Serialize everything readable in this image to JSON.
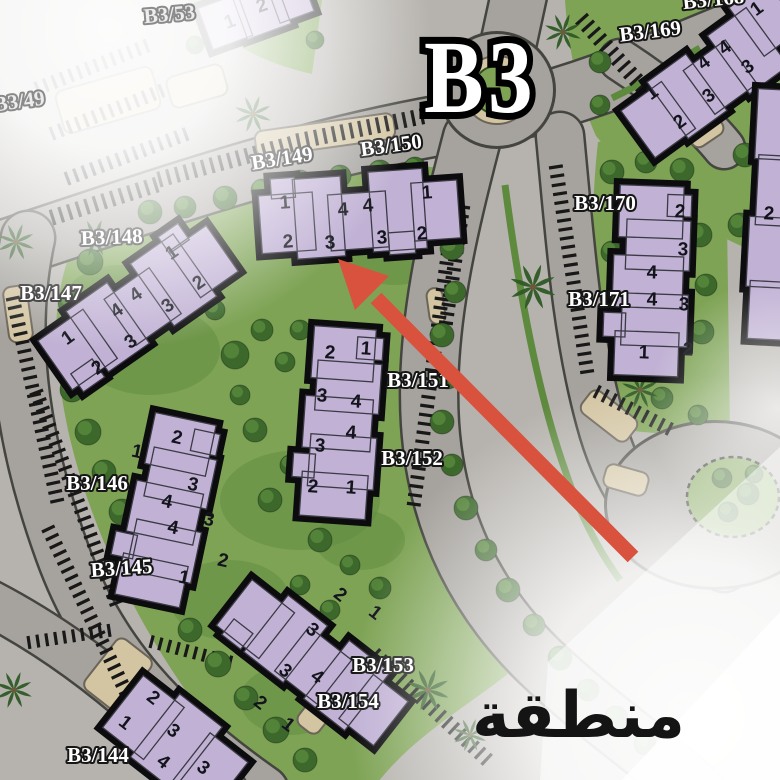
{
  "title": "B3",
  "arabic_label": "منطقة",
  "colors": {
    "base": "#b6b3ae",
    "road": "#a6a39e",
    "road_casing": "#45453f",
    "grass": "#7ea355",
    "grass_dark": "#5e8a3e",
    "tree": "#3c682c",
    "tree_hi": "#5d8f3d",
    "palm": "#2e5a25",
    "tan": "#d3c5a2",
    "tan_stroke": "#6b6459",
    "building_fill": "#c1b2d5",
    "building_stroke": "#0c0c0e",
    "unit_color": "#14141c",
    "label_fill": "#ffffff",
    "label_stroke": "#161616",
    "faded_label_fill": "#ececec",
    "faded_label_stroke": "#787878",
    "arrow": "#d8523e",
    "tick": "#181818"
  },
  "street_labels": [
    {
      "text": "B3/53",
      "x": 170,
      "y": 21,
      "rot": -5,
      "faded": true
    },
    {
      "text": "B3/49",
      "x": 20,
      "y": 108,
      "rot": -8,
      "faded": true
    },
    {
      "text": "B3/149",
      "x": 283,
      "y": 165,
      "rot": -9,
      "faded": false
    },
    {
      "text": "B3/150",
      "x": 392,
      "y": 152,
      "rot": -8,
      "faded": false
    },
    {
      "text": "B3/148",
      "x": 112,
      "y": 244,
      "rot": -2,
      "faded": false
    },
    {
      "text": "B3/147",
      "x": 51,
      "y": 300,
      "rot": 0,
      "faded": false
    },
    {
      "text": "B3/146",
      "x": 97,
      "y": 490,
      "rot": 0,
      "faded": false
    },
    {
      "text": "B3/145",
      "x": 122,
      "y": 575,
      "rot": -4,
      "faded": false
    },
    {
      "text": "B3/144",
      "x": 98,
      "y": 762,
      "rot": 0,
      "faded": false
    },
    {
      "text": "B3/151",
      "x": 418,
      "y": 387,
      "rot": 0,
      "faded": false
    },
    {
      "text": "B3/152",
      "x": 412,
      "y": 465,
      "rot": 0,
      "faded": false
    },
    {
      "text": "B3/153",
      "x": 383,
      "y": 672,
      "rot": 0,
      "faded": false
    },
    {
      "text": "B3/154",
      "x": 348,
      "y": 708,
      "rot": 0,
      "faded": false
    },
    {
      "text": "B3/168",
      "x": 714,
      "y": 6,
      "rot": -6,
      "faded": false
    },
    {
      "text": "B3/169",
      "x": 651,
      "y": 38,
      "rot": -7,
      "faded": false
    },
    {
      "text": "B3/170",
      "x": 605,
      "y": 210,
      "rot": 0,
      "faded": false
    },
    {
      "text": "B3/171",
      "x": 599,
      "y": 306,
      "rot": 0,
      "faded": false
    }
  ],
  "buildings": [
    {
      "id": "b3-149-150",
      "cx": 357,
      "cy": 217,
      "rot": -4,
      "blocks": [
        [
          -97,
          -28,
          54,
          58
        ],
        [
          -62,
          -42,
          48,
          80
        ],
        [
          -28,
          -24,
          58,
          56
        ],
        [
          14,
          -44,
          54,
          80
        ],
        [
          56,
          -30,
          46,
          58
        ],
        [
          -84,
          -44,
          24,
          20
        ],
        [
          30,
          18,
          26,
          22
        ]
      ],
      "units": [
        [
          "1",
          285,
          203
        ],
        [
          "4",
          343,
          210
        ],
        [
          "4",
          368,
          206
        ],
        [
          "1",
          427,
          193
        ],
        [
          "2",
          288,
          242
        ],
        [
          "3",
          330,
          243
        ],
        [
          "3",
          382,
          238
        ],
        [
          "2",
          422,
          234
        ]
      ]
    },
    {
      "id": "b3-147-148",
      "cx": 137,
      "cy": 308,
      "rot": -35,
      "blocks": [
        [
          -100,
          -30,
          55,
          60
        ],
        [
          -60,
          -38,
          50,
          74
        ],
        [
          -22,
          -26,
          55,
          56
        ],
        [
          20,
          -40,
          52,
          76
        ],
        [
          58,
          -28,
          46,
          56
        ],
        [
          -92,
          16,
          26,
          22
        ],
        [
          58,
          -46,
          24,
          20
        ]
      ],
      "units": [
        [
          "1",
          172,
          253
        ],
        [
          "2",
          199,
          283
        ],
        [
          "4",
          136,
          295
        ],
        [
          "4",
          117,
          311
        ],
        [
          "3",
          168,
          306
        ],
        [
          "1",
          68,
          338
        ],
        [
          "3",
          131,
          342
        ],
        [
          "2",
          98,
          368
        ]
      ]
    },
    {
      "id": "b3-151-152",
      "cx": 344,
      "cy": 420,
      "rot": 4,
      "blocks": [
        [
          -36,
          -92,
          62,
          52
        ],
        [
          -30,
          -58,
          64,
          50
        ],
        [
          -40,
          -22,
          68,
          52
        ],
        [
          -32,
          16,
          66,
          52
        ],
        [
          -38,
          54,
          66,
          44
        ],
        [
          8,
          -84,
          26,
          22
        ],
        [
          -48,
          36,
          22,
          24
        ]
      ],
      "units": [
        [
          "2",
          330,
          353
        ],
        [
          "1",
          366,
          349
        ],
        [
          "3",
          322,
          396
        ],
        [
          "4",
          356,
          402
        ],
        [
          "4",
          351,
          433
        ],
        [
          "3",
          320,
          446
        ],
        [
          "2",
          313,
          487
        ],
        [
          "1",
          351,
          488
        ]
      ]
    },
    {
      "id": "b3-145-146",
      "cx": 172,
      "cy": 508,
      "rot": 12,
      "blocks": [
        [
          -36,
          -90,
          62,
          52
        ],
        [
          -30,
          -56,
          64,
          50
        ],
        [
          -40,
          -20,
          68,
          52
        ],
        [
          -32,
          18,
          66,
          52
        ],
        [
          -38,
          54,
          66,
          42
        ],
        [
          6,
          -82,
          26,
          22
        ],
        [
          -50,
          34,
          22,
          24
        ]
      ],
      "units": [
        [
          "1",
          137,
          452
        ],
        [
          "2",
          177,
          438
        ],
        [
          "3",
          193,
          485
        ],
        [
          "4",
          167,
          502
        ],
        [
          "4",
          173,
          528
        ],
        [
          "3",
          209,
          520
        ],
        [
          "2",
          223,
          561
        ],
        [
          "1",
          184,
          578
        ]
      ]
    },
    {
      "id": "b3-153-154",
      "cx": 312,
      "cy": 662,
      "rot": 38,
      "blocks": [
        [
          -98,
          -28,
          54,
          58
        ],
        [
          -60,
          -38,
          50,
          72
        ],
        [
          -24,
          -26,
          54,
          56
        ],
        [
          16,
          -40,
          52,
          74
        ],
        [
          56,
          -28,
          44,
          56
        ],
        [
          -88,
          14,
          24,
          20
        ]
      ],
      "units": [
        [
          "2",
          340,
          595
        ],
        [
          "1",
          375,
          613
        ],
        [
          "3",
          312,
          630
        ],
        [
          "3",
          285,
          671
        ],
        [
          "4",
          317,
          677
        ],
        [
          "2",
          260,
          703
        ],
        [
          "1",
          288,
          725
        ]
      ]
    },
    {
      "id": "b3-144",
      "cx": 168,
      "cy": 738,
      "rot": 38,
      "blocks": [
        [
          -58,
          -34,
          52,
          66
        ],
        [
          -18,
          -42,
          54,
          80
        ],
        [
          30,
          -30,
          48,
          62
        ]
      ],
      "units": [
        [
          "2",
          153,
          698
        ],
        [
          "1",
          125,
          723
        ],
        [
          "3",
          173,
          731
        ],
        [
          "4",
          163,
          762
        ],
        [
          "3",
          203,
          768
        ]
      ]
    },
    {
      "id": "b3-170-171",
      "cx": 655,
      "cy": 278,
      "rot": 2,
      "blocks": [
        [
          -38,
          -92,
          64,
          52
        ],
        [
          -30,
          -58,
          64,
          50
        ],
        [
          -42,
          -22,
          70,
          52
        ],
        [
          -32,
          16,
          66,
          52
        ],
        [
          -38,
          54,
          64,
          44
        ],
        [
          10,
          -84,
          24,
          22
        ],
        [
          -50,
          36,
          22,
          24
        ]
      ],
      "units": [
        [
          "2",
          680,
          212
        ],
        [
          "3",
          683,
          250
        ],
        [
          "4",
          652,
          273
        ],
        [
          "4",
          652,
          300
        ],
        [
          "3",
          684,
          305
        ],
        [
          "2",
          688,
          350
        ],
        [
          "1",
          644,
          353
        ]
      ]
    },
    {
      "id": "b3-168-169",
      "cx": 707,
      "cy": 83,
      "rot": -36,
      "blocks": [
        [
          -86,
          -28,
          50,
          58
        ],
        [
          -48,
          -36,
          48,
          70
        ],
        [
          -12,
          -24,
          52,
          54
        ],
        [
          28,
          -38,
          48,
          72
        ],
        [
          62,
          -48,
          46,
          60
        ]
      ],
      "units": [
        [
          "1",
          652,
          93
        ],
        [
          "2",
          680,
          122
        ],
        [
          "4",
          704,
          63
        ],
        [
          "4",
          725,
          48
        ],
        [
          "3",
          709,
          96
        ],
        [
          "3",
          748,
          67
        ],
        [
          "1",
          757,
          9
        ]
      ]
    },
    {
      "id": "b3-53-fragment",
      "cx": 247,
      "cy": 14,
      "rot": -20,
      "blocks": [
        [
          -44,
          -22,
          42,
          44
        ],
        [
          -8,
          -30,
          46,
          54
        ],
        [
          28,
          -18,
          36,
          38
        ]
      ],
      "units": [
        [
          "1",
          230,
          22
        ],
        [
          "2",
          262,
          6
        ]
      ]
    },
    {
      "id": "right-edge-fragment",
      "cx": 782,
      "cy": 210,
      "rot": 3,
      "blocks": [
        [
          -30,
          -120,
          56,
          70
        ],
        [
          -26,
          -54,
          52,
          70
        ],
        [
          -32,
          8,
          56,
          70
        ],
        [
          -28,
          72,
          50,
          58
        ]
      ],
      "units": [
        [
          "2",
          769,
          214
        ]
      ]
    }
  ],
  "roads": [
    {
      "d": "M -20,258 C 140,206 290,150 460,122 C 570,102 660,62 790,8",
      "w": 58
    },
    {
      "d": "M 28,238 C 8,330 20,436 62,552 C 98,652 162,722 262,792",
      "w": 52
    },
    {
      "d": "M 472,138 C 448,230 424,330 430,424 C 436,514 470,594 540,662 C 592,712 646,748 696,792",
      "w": 56
    },
    {
      "d": "M 560,136 C 570,240 576,332 600,420 C 618,488 652,540 724,568",
      "w": 46
    },
    {
      "d": "M 497,96 L 520,-10",
      "w": 54
    },
    {
      "d": "M -20,598 C 60,638 142,700 224,790",
      "w": 44
    },
    {
      "d": "M 620,60 C 660,86 700,118 724,148",
      "w": 40
    }
  ],
  "green_areas": [
    "M 68,258 C 160,190 300,158 452,168 C 446,270 430,330 432,430 C 434,520 462,600 520,664 C 470,706 420,730 378,782 L 262,782 C 170,690 96,556 68,430 C 52,352 52,310 68,258 Z",
    "M 565,0 L 782,0 L 782,262 C 706,236 646,196 596,136 C 578,96 568,48 565,0 Z",
    "M 598,142 C 648,132 700,136 726,150 L 730,432 C 690,436 648,434 614,428 C 592,330 588,230 598,142 Z",
    "M 188,0 L 322,0 L 312,74 C 258,62 216,38 188,0 Z"
  ],
  "medians": [
    "M 505,185 C 520,300 540,400 565,470 C 580,515 598,550 620,580",
    "M 612,98 C 646,82 676,62 700,48"
  ],
  "grass_patches": [
    [
      150,
      350,
      70,
      45
    ],
    [
      300,
      500,
      80,
      50
    ],
    [
      230,
      600,
      60,
      40
    ],
    [
      395,
      250,
      50,
      35
    ],
    [
      360,
      540,
      45,
      30
    ],
    [
      655,
      250,
      40,
      55
    ],
    [
      690,
      85,
      45,
      30
    ],
    [
      120,
      300,
      55,
      35
    ],
    [
      290,
      700,
      50,
      35
    ]
  ],
  "plaza": {
    "cx": 497,
    "cy": 90,
    "r": 56,
    "ring_r": 34,
    "green_r": 24
  },
  "se_plaza": {
    "cx": 715,
    "cy": 505,
    "rx": 108,
    "ry": 82
  },
  "island": {
    "cx": 733,
    "cy": 497,
    "rx": 46,
    "ry": 40
  },
  "tan_blobs": [
    [
      58,
      78,
      100,
      44,
      -16
    ],
    [
      168,
      70,
      58,
      32,
      -16
    ],
    [
      255,
      122,
      140,
      26,
      -8
    ],
    [
      580,
      402,
      58,
      28,
      38
    ],
    [
      688,
      122,
      36,
      20,
      -34
    ],
    [
      318,
      652,
      26,
      86,
      38
    ],
    [
      6,
      286,
      24,
      56,
      -8
    ],
    [
      96,
      642,
      44,
      64,
      38
    ],
    [
      604,
      468,
      44,
      24,
      16
    ],
    [
      428,
      288,
      16,
      36,
      -8
    ]
  ],
  "parking_strips": [
    [
      162,
      187,
      300,
      150,
      16
    ],
    [
      300,
      149,
      425,
      124,
      16
    ],
    [
      55,
      225,
      160,
      192,
      16
    ],
    [
      588,
      14,
      690,
      128,
      -16
    ],
    [
      6,
      300,
      52,
      510,
      14
    ],
    [
      30,
      395,
      112,
      612,
      14
    ],
    [
      42,
      532,
      122,
      700,
      14
    ],
    [
      448,
      200,
      406,
      510,
      14
    ],
    [
      470,
      208,
      452,
      330,
      -14
    ],
    [
      370,
      660,
      485,
      768,
      15
    ],
    [
      549,
      168,
      581,
      378,
      14
    ],
    [
      594,
      398,
      668,
      436,
      14
    ],
    [
      40,
      95,
      150,
      52,
      14
    ],
    [
      55,
      140,
      170,
      95,
      14
    ],
    [
      70,
      185,
      190,
      140,
      14
    ],
    [
      28,
      636,
      115,
      623,
      -13
    ],
    [
      150,
      648,
      235,
      670,
      13
    ]
  ],
  "trees": [
    [
      150,
      212,
      12
    ],
    [
      185,
      207,
      11
    ],
    [
      225,
      198,
      12
    ],
    [
      262,
      190,
      11
    ],
    [
      300,
      182,
      12
    ],
    [
      340,
      176,
      11
    ],
    [
      380,
      172,
      12
    ],
    [
      415,
      168,
      11
    ],
    [
      90,
      262,
      13
    ],
    [
      70,
      302,
      12
    ],
    [
      62,
      345,
      13
    ],
    [
      72,
      390,
      12
    ],
    [
      88,
      432,
      13
    ],
    [
      104,
      472,
      12
    ],
    [
      122,
      512,
      13
    ],
    [
      142,
      552,
      12
    ],
    [
      162,
      592,
      13
    ],
    [
      190,
      630,
      12
    ],
    [
      218,
      664,
      13
    ],
    [
      246,
      698,
      12
    ],
    [
      276,
      730,
      13
    ],
    [
      305,
      760,
      12
    ],
    [
      235,
      355,
      14
    ],
    [
      262,
      330,
      11
    ],
    [
      285,
      362,
      10
    ],
    [
      240,
      395,
      10
    ],
    [
      300,
      330,
      10
    ],
    [
      215,
      310,
      10
    ],
    [
      255,
      430,
      12
    ],
    [
      290,
      465,
      10
    ],
    [
      270,
      500,
      12
    ],
    [
      320,
      540,
      12
    ],
    [
      350,
      565,
      10
    ],
    [
      380,
      588,
      11
    ],
    [
      300,
      585,
      10
    ],
    [
      330,
      610,
      10
    ],
    [
      440,
      205,
      11
    ],
    [
      452,
      248,
      12
    ],
    [
      455,
      292,
      11
    ],
    [
      442,
      335,
      12
    ],
    [
      448,
      378,
      11
    ],
    [
      442,
      422,
      12
    ],
    [
      452,
      465,
      11
    ],
    [
      466,
      508,
      12
    ],
    [
      486,
      550,
      11
    ],
    [
      508,
      590,
      12
    ],
    [
      534,
      625,
      11
    ],
    [
      560,
      658,
      12
    ],
    [
      588,
      690,
      11
    ],
    [
      616,
      718,
      12
    ],
    [
      645,
      744,
      11
    ],
    [
      612,
      172,
      12
    ],
    [
      646,
      162,
      11
    ],
    [
      682,
      170,
      12
    ],
    [
      612,
      252,
      11
    ],
    [
      618,
      305,
      12
    ],
    [
      628,
      352,
      11
    ],
    [
      700,
      235,
      12
    ],
    [
      706,
      285,
      11
    ],
    [
      702,
      332,
      12
    ],
    [
      662,
      398,
      11
    ],
    [
      698,
      415,
      10
    ],
    [
      600,
      62,
      11
    ],
    [
      745,
      155,
      12
    ],
    [
      772,
      190,
      11
    ],
    [
      740,
      225,
      12
    ],
    [
      600,
      105,
      10
    ],
    [
      195,
      45,
      9
    ],
    [
      315,
      40,
      9
    ],
    [
      722,
      478,
      10
    ],
    [
      748,
      494,
      11
    ],
    [
      728,
      512,
      10
    ],
    [
      754,
      474,
      9
    ]
  ],
  "palms": [
    [
      563,
      32,
      1
    ],
    [
      253,
      114,
      1
    ],
    [
      533,
      287,
      1.25
    ],
    [
      95,
      238,
      1
    ],
    [
      16,
      242,
      1
    ],
    [
      640,
      390,
      1
    ],
    [
      428,
      690,
      1.15
    ],
    [
      14,
      690,
      1
    ],
    [
      470,
      735,
      0.9
    ]
  ],
  "arrow": {
    "tail": [
      633,
      557
    ],
    "line_end": [
      376,
      298
    ],
    "head": [
      [
        338,
        259
      ],
      [
        389,
        276
      ],
      [
        355,
        310
      ]
    ]
  }
}
